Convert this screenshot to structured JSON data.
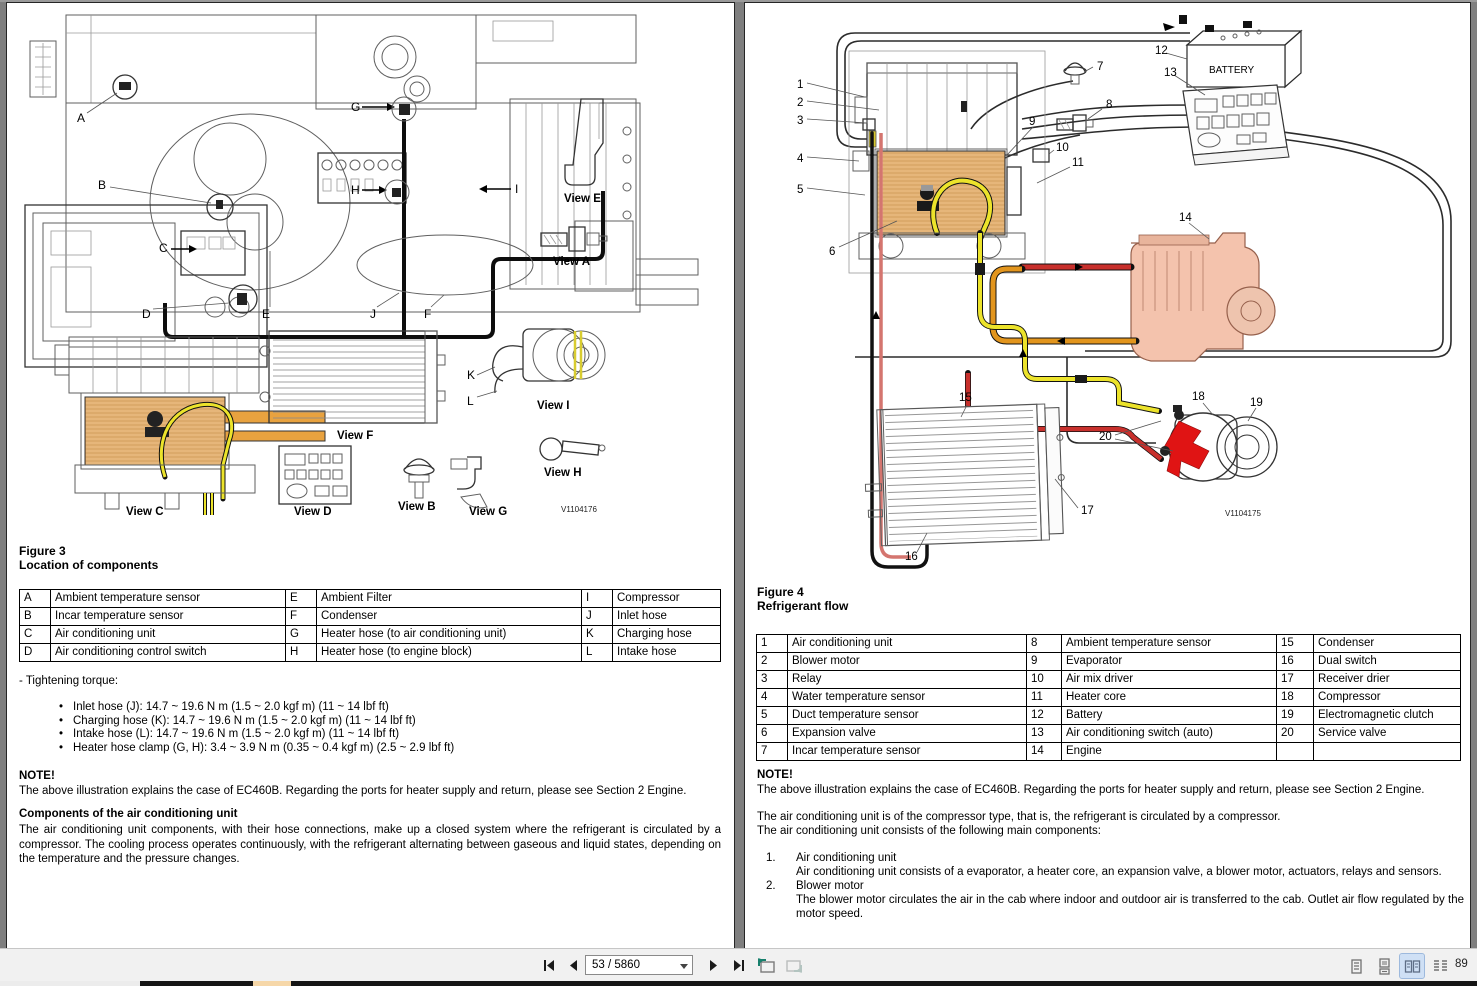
{
  "toolbar": {
    "page_display": "53 / 5860",
    "zoom_level": "89"
  },
  "left_page": {
    "figure_label": "Figure 3",
    "figure_title": "Location of components",
    "table_rows": [
      [
        "A",
        "Ambient temperature sensor",
        "E",
        "Ambient Filter",
        "I",
        "Compressor"
      ],
      [
        "B",
        "Incar temperature sensor",
        "F",
        "Condenser",
        "J",
        "Inlet hose"
      ],
      [
        "C",
        "Air conditioning unit",
        "G",
        "Heater hose (to air conditioning unit)",
        "K",
        "Charging hose"
      ],
      [
        "D",
        "Air conditioning control switch",
        "H",
        "Heater hose (to engine block)",
        "L",
        "Intake hose"
      ]
    ],
    "torque_heading": "- Tightening torque:",
    "torque_items": [
      "Inlet hose (J): 14.7 ~ 19.6 N m (1.5 ~ 2.0 kgf m) (11 ~ 14 lbf ft)",
      "Charging hose (K): 14.7 ~ 19.6 N m (1.5 ~ 2.0 kgf m) (11 ~ 14 lbf ft)",
      "Intake hose (L): 14.7 ~ 19.6 N m (1.5 ~ 2.0 kgf m) (11 ~ 14 lbf ft)",
      "Heater hose clamp (G, H): 3.4 ~ 3.9 N m (0.35 ~ 0.4 kgf m) (2.5 ~ 2.9 lbf ft)"
    ],
    "note_heading": "NOTE!",
    "note_text": "The above illustration explains the case of EC460B. Regarding the ports for heater supply and return, please see Section 2 Engine.",
    "section_heading": "Components of the air conditioning unit",
    "section_text": "The air conditioning unit components, with their hose connections, make up a closed system where the refrigerant is circulated by a compressor. The cooling process operates continuously, with the refrigerant alternating between gaseous and liquid states, depending on the temperature and the pressure changes.",
    "diagram": {
      "callouts": [
        "A",
        "B",
        "C",
        "D",
        "E",
        "F",
        "G",
        "H",
        "I",
        "J",
        "K",
        "L"
      ],
      "views": {
        "e": "View E",
        "a": "View A",
        "c": "View C",
        "f": "View F",
        "d": "View D",
        "b": "View B",
        "g": "View G",
        "i": "View I",
        "h": "View H"
      },
      "figure_id": "V1104176"
    }
  },
  "right_page": {
    "figure_label": "Figure 4",
    "figure_title": "Refrigerant flow",
    "table_rows": [
      [
        "1",
        "Air conditioning unit",
        "8",
        "Ambient temperature sensor",
        "15",
        "Condenser"
      ],
      [
        "2",
        "Blower motor",
        "9",
        "Evaporator",
        "16",
        "Dual switch"
      ],
      [
        "3",
        "Relay",
        "10",
        "Air mix driver",
        "17",
        "Receiver drier"
      ],
      [
        "4",
        "Water temperature sensor",
        "11",
        "Heater core",
        "18",
        "Compressor"
      ],
      [
        "5",
        "Duct temperature sensor",
        "12",
        "Battery",
        "19",
        "Electromagnetic clutch"
      ],
      [
        "6",
        "Expansion valve",
        "13",
        "Air conditioning switch (auto)",
        "20",
        "Service valve"
      ],
      [
        "7",
        "Incar temperature sensor",
        "14",
        "Engine",
        "",
        ""
      ]
    ],
    "note_heading": "NOTE!",
    "note_text": "The above illustration explains the case of EC460B. Regarding the ports for heater supply and return, please see Section 2 Engine.",
    "para1": "The air conditioning unit is of the compressor type, that is, the refrigerant is circulated by a compressor.",
    "para2": "The air conditioning unit consists of the following main components:",
    "list_items": [
      {
        "num": "1.",
        "title": "Air conditioning unit",
        "body": "Air conditioning unit consists of a evaporator, a heater core, an expansion valve, a blower motor, actuators, relays and sensors."
      },
      {
        "num": "2.",
        "title": "Blower motor",
        "body": "The blower motor circulates the air in the cab where indoor and outdoor air is transferred to the cab. Outlet air flow regulated by the motor speed."
      }
    ],
    "diagram": {
      "battery_label": "BATTERY",
      "figure_id": "V1104175",
      "callouts": [
        "1",
        "2",
        "3",
        "4",
        "5",
        "6",
        "7",
        "8",
        "9",
        "10",
        "11",
        "12",
        "13",
        "14",
        "15",
        "16",
        "17",
        "18",
        "19",
        "20"
      ]
    }
  },
  "colors": {
    "hose_red": "#c8302c",
    "hose_yellow": "#ece32b",
    "hose_orange": "#e2951d",
    "core_orange": "#f2cf9b",
    "engine_salmon": "#f4c3ad",
    "clutch_red": "#e01414",
    "active_layout_bg": "#cfe0f5"
  }
}
